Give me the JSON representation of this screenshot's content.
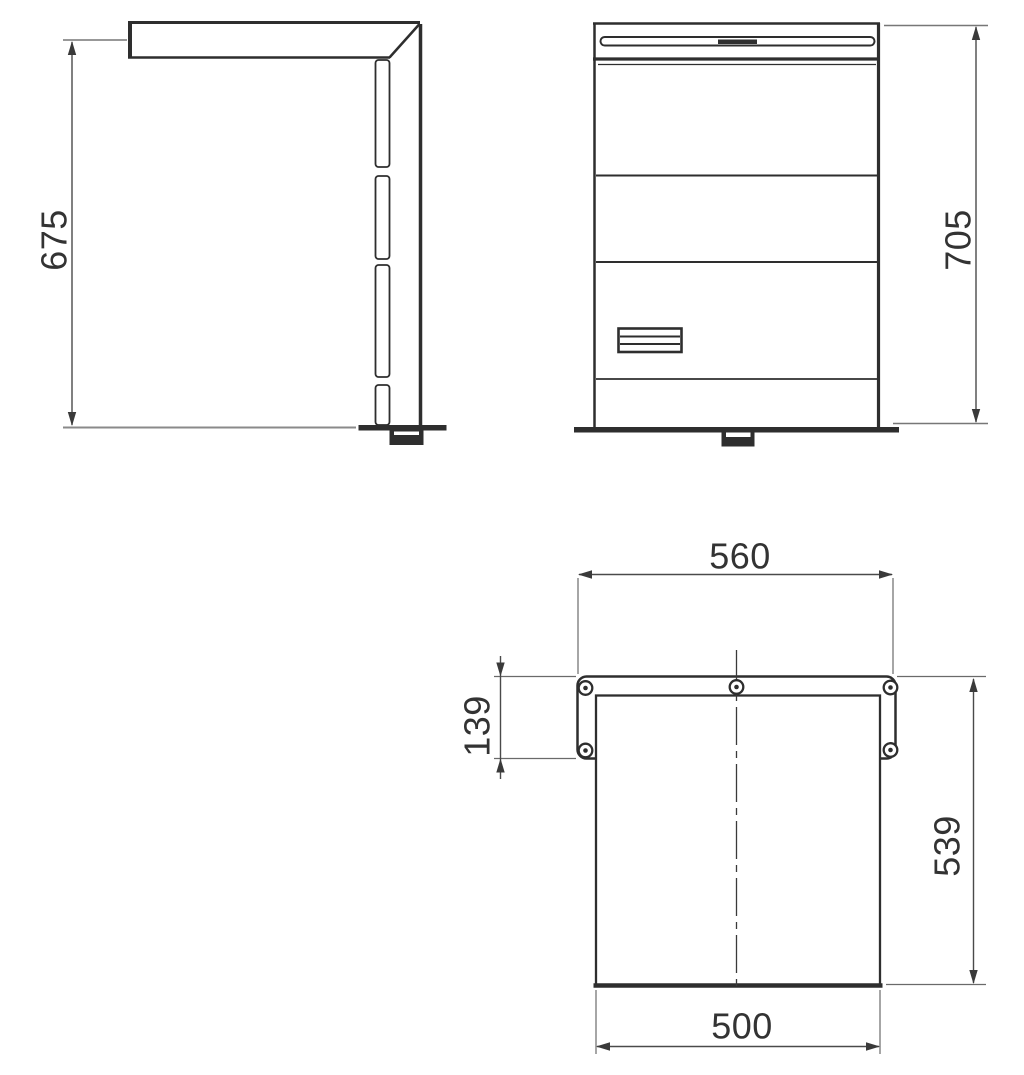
{
  "drawing": {
    "kind": "three-view technical dimension drawing",
    "views": {
      "side_view_label": "side-view",
      "front_view_label": "front-view",
      "top_view_label": "top-view"
    }
  },
  "dimensions": {
    "side_height": "675",
    "front_height": "705",
    "plate_width": "560",
    "plate_depth": "139",
    "top_depth": "539",
    "top_width": "500"
  },
  "colors": {
    "background": "#ffffff",
    "outline": "#2e2e2e",
    "dimension_line": "#4a4a4a",
    "extension_line": "#777777",
    "floor_line": "#8a8a8a",
    "text": "#333333"
  }
}
